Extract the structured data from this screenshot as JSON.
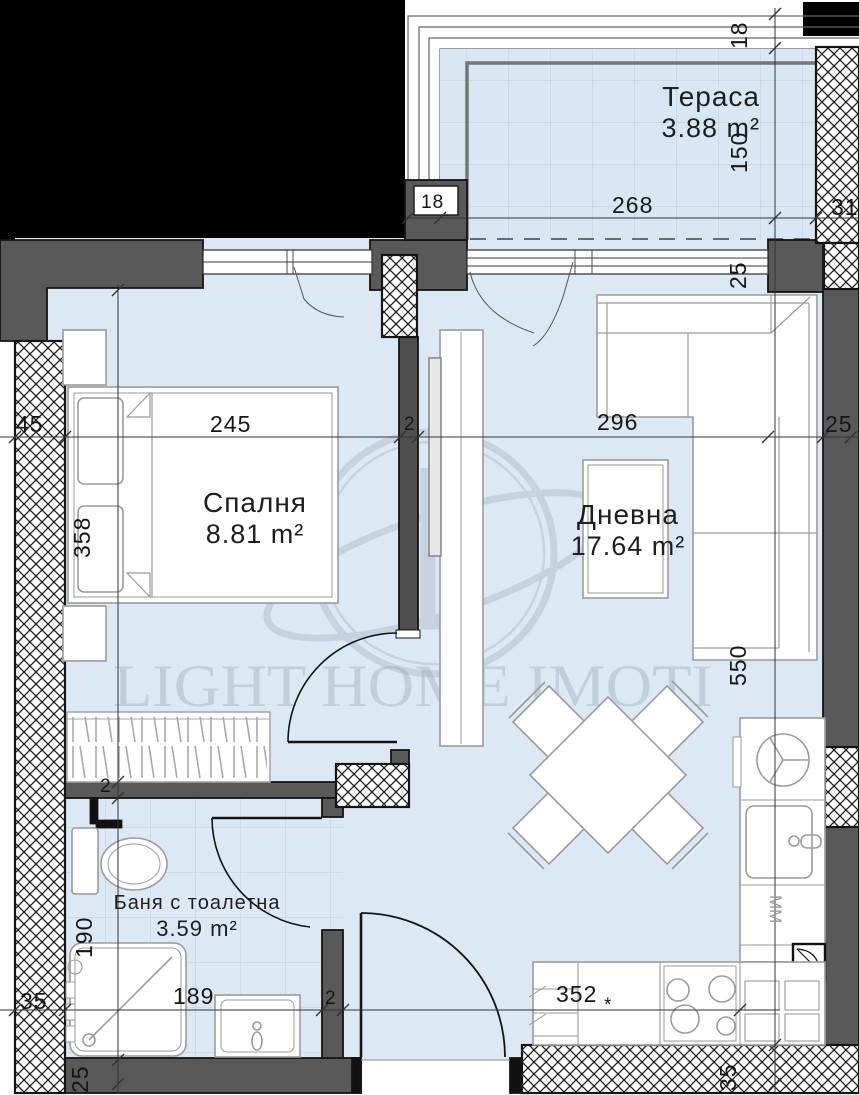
{
  "watermark": {
    "text": "LIGHT HOME IMOTI"
  },
  "rooms": {
    "terrace": {
      "name": "Тераса",
      "area": "3.88 m²"
    },
    "bedroom": {
      "name": "Спалня",
      "area": "8.81 m²"
    },
    "living": {
      "name": "Дневна",
      "area": "17.64 m²"
    },
    "bathroom": {
      "name": "Баня с тоалетна",
      "area": "3.59 m²"
    }
  },
  "appliances": {
    "microwave_label": "MM"
  },
  "dimensions": {
    "terrace_wall_top": "18",
    "terrace_depth": "150",
    "terrace_width": "268",
    "terrace_wall_right": "31",
    "column_width": "18",
    "window_corner": "25",
    "left_wall": "45",
    "bedroom_width": "245",
    "partition_a": "2",
    "living_width": "296",
    "right_wall": "25",
    "bedroom_depth": "358",
    "living_depth": "550",
    "partition_b": "2",
    "bathroom_depth": "190",
    "bath_wall": "35",
    "bathroom_width": "189",
    "partition_c": "2",
    "kitchen_width": "352",
    "kitchen_note": "*",
    "bottom_wall": "35",
    "bottom_wall_b": "25"
  },
  "colors": {
    "floor": "#dce9f5",
    "wall_dark": "#595959",
    "outline": "#141414",
    "furniture_stroke": "#9b9b9b",
    "tile_line": "#b9cede",
    "watermark_gray": "#8fa0b0"
  }
}
